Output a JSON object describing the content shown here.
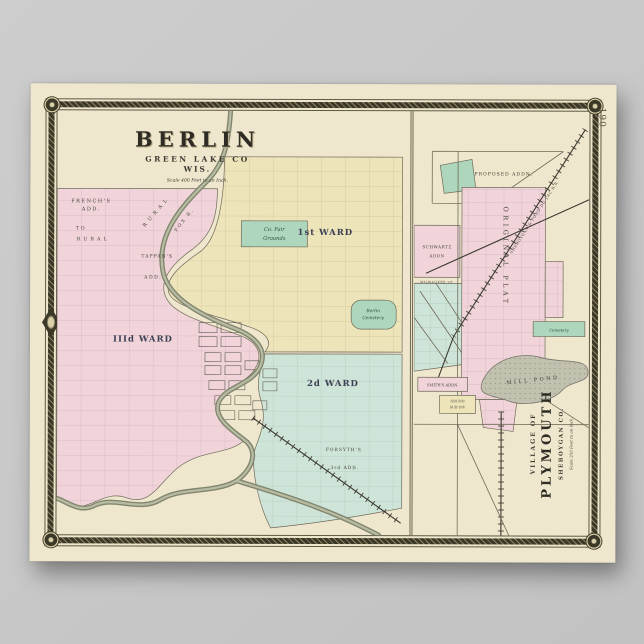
{
  "colors": {
    "paper": "#efe7cd",
    "pink": "#f0d4da",
    "yellow": "#ede4ba",
    "teal": "#cfe4d8",
    "green": "#aed6bc",
    "river": "#82866f",
    "pond": "#c2c1b0",
    "frame": "#3c3828",
    "background": "#c8c8c8"
  },
  "page_number": "190",
  "berlin": {
    "title": "BERLIN",
    "county": "GREEN LAKE CO",
    "state": "WIS.",
    "scale": "Scale 400 Feet to an Inch.",
    "labels": {
      "frenchs_1": "FRENCH'S",
      "frenchs_2": "ADD.",
      "to": "TO",
      "rural": "RURAL",
      "rural_diag": "RURAL",
      "tappans_1": "TAPPAN'S",
      "tappans_2": "ADD.",
      "ward3": "IIId WARD",
      "ward1": "1st WARD",
      "ward2": "2d WARD",
      "forsyths_1": "FORSYTH'S",
      "forsyths_2": "3rd ADD.",
      "fairgrounds_1": "Co. Fair",
      "fairgrounds_2": "Grounds",
      "cemetery_1": "Berlin",
      "cemetery_2": "Cemetery",
      "fox_river": "FOX R."
    }
  },
  "plymouth": {
    "title_prefix": "VILLAGE OF",
    "title": "PLYMOUTH",
    "county": "SHEBOYGAN CO.",
    "scale": "Scale 350 Feet to an Inch.",
    "labels": {
      "taylors": "TAYLORS PROPOSED ADDN.",
      "schwartz_1": "SCHWARTZ",
      "schwartz_2": "ADDN",
      "milwaukee_st": "MILWAUKEE ST.",
      "original_plat": "ORIGINAL PLAT",
      "smiths": "SMITH'S ADDN.",
      "grund_1": "GRUND",
      "grund_2": "SUB DIV",
      "cemetery": "Cemetery",
      "mill_pond": "MILL POND",
      "railroad": "SHEBOYGAN & FOND DU LAC R.R."
    }
  }
}
